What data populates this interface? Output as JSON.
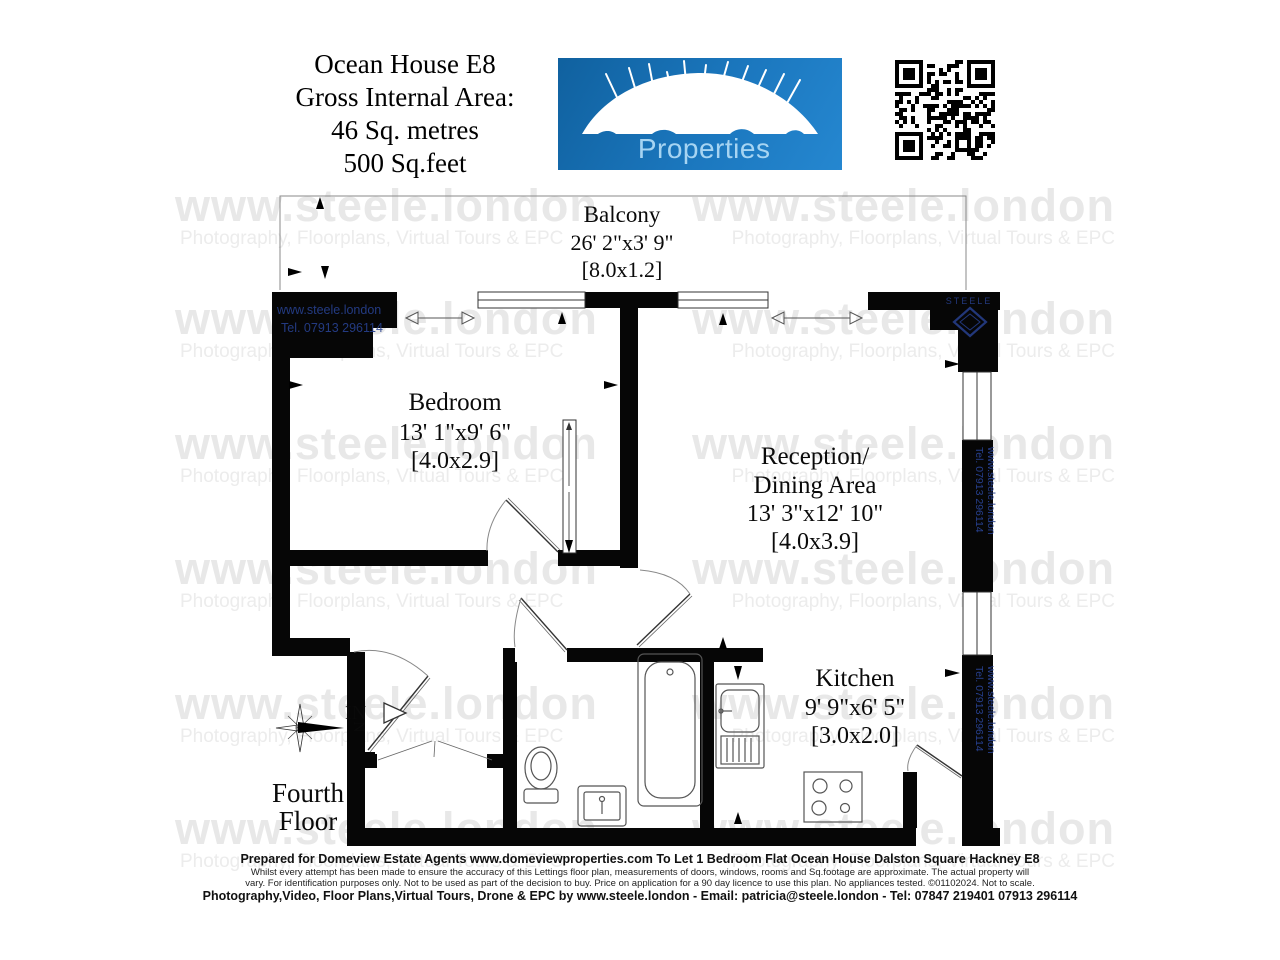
{
  "header": {
    "title_lines": [
      "Ocean House E8",
      "Gross Internal Area:",
      "46 Sq. metres",
      "500 Sq.feet"
    ]
  },
  "logo": {
    "name_primary": "Domeview",
    "name_secondary": "Properties",
    "bg_color": "#1b77be",
    "secondary_text_color": "#a6d4f2"
  },
  "qr_label": "qr-code",
  "watermark": {
    "big": "www.steele.london",
    "small": "Photography, Floorplans, Virtual Tours & EPC"
  },
  "plan": {
    "balcony": {
      "name": "Balcony",
      "imperial": "26' 2\"x3' 9\"",
      "metric": "[8.0x1.2]"
    },
    "bedroom": {
      "name": "Bedroom",
      "imperial": "13' 1\"x9' 6\"",
      "metric": "[4.0x2.9]"
    },
    "reception": {
      "name_line1": "Reception/",
      "name_line2": "Dining Area",
      "imperial": "13' 3\"x12' 10\"",
      "metric": "[4.0x3.9]"
    },
    "kitchen": {
      "name": "Kitchen",
      "imperial": "9' 9\"x6' 5\"",
      "metric": "[3.0x2.0]"
    },
    "entrance_label": "IN",
    "floor_line1": "Fourth",
    "floor_line2": "Floor",
    "compass_north": "N",
    "wall_text_site": "www.steele.london",
    "wall_text_tel": "Tel. 07913 296114",
    "corner_brand": "STEELE"
  },
  "footer": {
    "line1": "Prepared for Domeview Estate Agents  www.domeviewproperties.com To Let 1 Bedroom Flat Ocean House Dalston Square Hackney E8",
    "line2": "Whilst every attempt has been made to ensure the accuracy of this Lettings floor plan, measurements of doors, windows, rooms and Sq.footage are approximate. The actual property will",
    "line3": "vary. For identification purposes only. Not to be used as part of the decision to buy. Price on application for a 90 day licence to use this plan. No appliances tested. ©01102024. Not to scale.",
    "line4": "Photography,Video, Floor Plans,Virtual Tours, Drone & EPC by   www.steele.london - Email: patricia@steele.london - Tel: 07847 219401   07913 296114"
  },
  "colors": {
    "wall": "#060606",
    "watermark": "#e8e8e8",
    "brand_blue": "#27408f",
    "logo_blue": "#1b77be"
  }
}
